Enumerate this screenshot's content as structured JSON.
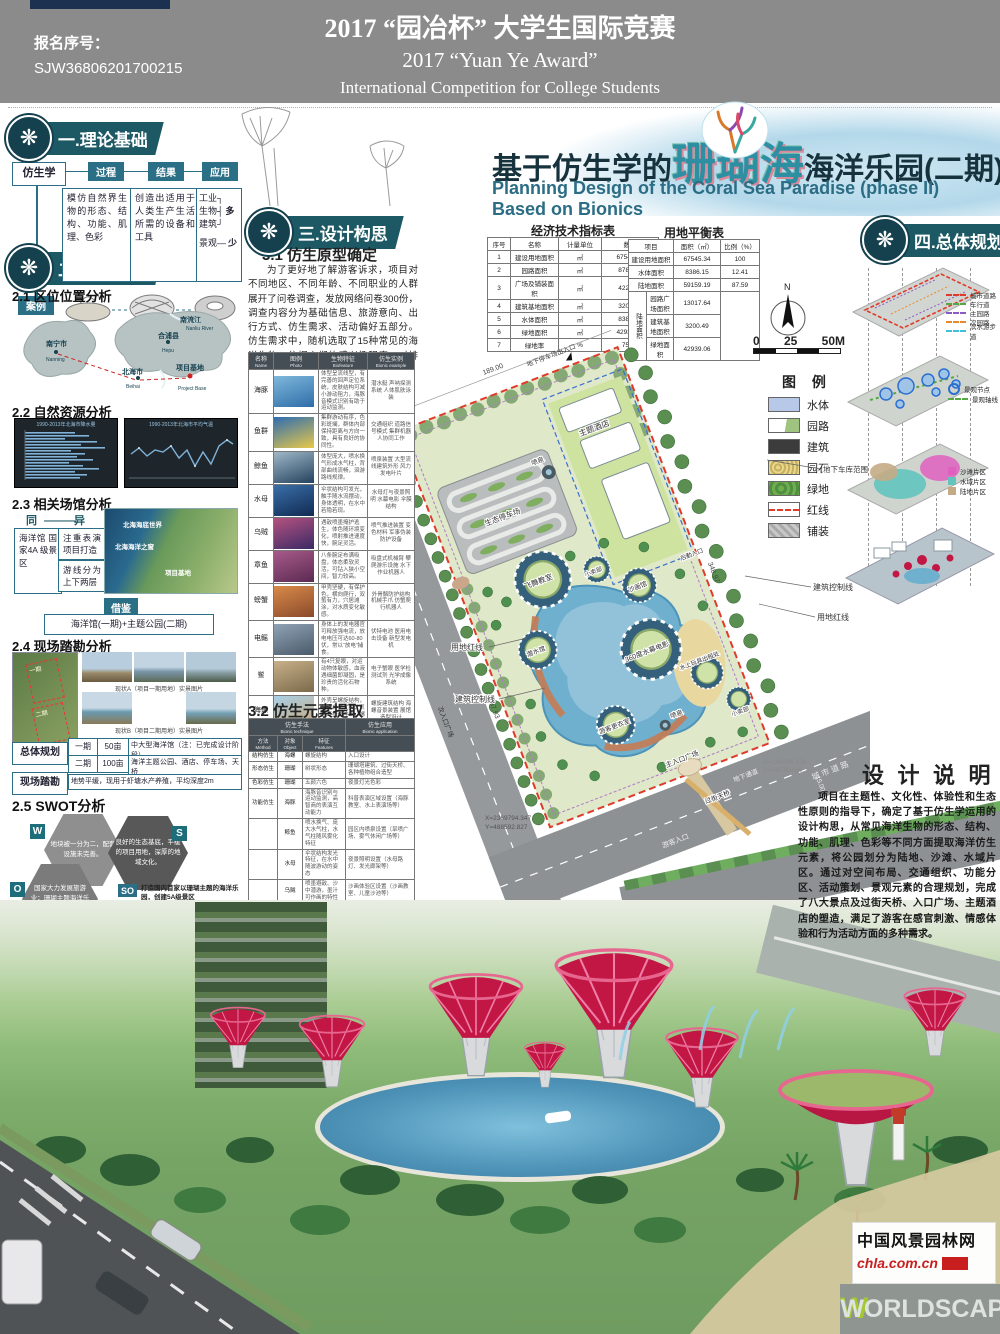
{
  "colors": {
    "accent_teal": "#1d5964",
    "diagram_teal": "#2a6f86",
    "red_line": "#e03a2a",
    "header_gray": "#8b8b8b",
    "table_header": "#454e55",
    "canopy_pink": "#c21744"
  },
  "header": {
    "entry_label": "报名序号：",
    "entry_no": "SJW36806201700215",
    "title_cn": "2017 “园冶杯” 大学生国际竞赛",
    "title_award": "2017 “Yuan Ye Award”",
    "title_en": "International Competition for College Students"
  },
  "title": {
    "cn_prefix": "基于仿生学的",
    "cn_highlight": "珊瑚海",
    "cn_suffix": "海洋乐园(二期)规划设计",
    "en": "Planning Design of the Coral Sea Paradise (phase II) Based on Bionics"
  },
  "badges": {
    "b1": "一.理论基础",
    "b2": "二.前期分析",
    "b3": "三.设计构思",
    "b4": "四.总体规划"
  },
  "theory": {
    "subject": "仿生学",
    "stage1": "过程",
    "stage2": "结果",
    "stage3": "应用",
    "box1": "模仿自然界生物的形态、结构、功能、肌理、色彩",
    "box2": "创造出适用于人类生产生活所需的设备和工具",
    "app1": "工业",
    "app2": "生物",
    "app3": "建筑",
    "app4": "景观",
    "more": "多",
    "less": "少",
    "case_label": "案例"
  },
  "loc": {
    "heading": "2.1 区位位置分析",
    "nanning": "南宁市",
    "nanning_en": "Nanning",
    "hepu": "合浦县",
    "hepu_en": "Hepu",
    "beihai": "北海市",
    "beihai_en": "Beihai",
    "base": "项目基地",
    "base_en": "Project Base",
    "river": "南流江",
    "river_en": "Nanliu River"
  },
  "nature": {
    "heading": "2.2 自然资源分析",
    "chart1_title": "1990-2013年北海市降水量",
    "chart2_title": "1990-2013年北海市平均气温"
  },
  "venues": {
    "heading": "2.3 相关场馆分析",
    "same": "同",
    "diff": "异",
    "box_same": "海洋馆 国家4A 级景区",
    "box_d1": "注重表演 项目打造",
    "box_d2": "游线分为 上下两层",
    "tag1": "北海海底世界",
    "tag2": "北海海洋之窗",
    "tag3": "项目基地",
    "ref_label": "借鉴",
    "ref_text": "海洋馆(一期)+主题公园(二期)"
  },
  "survey": {
    "heading": "2.4 现场踏勘分析",
    "tag1": "一期",
    "tag2": "二期",
    "cap1": "现状A（项目一期用地）实景图片",
    "cap2": "现状B（项目二期用地）实景图片",
    "flow_left1": "总体规划",
    "flow_left2": "现场踏勘",
    "p1": "一期",
    "a1": "50亩",
    "d1": "中大型海洋馆（注：已完成设计阶段）",
    "p2": "二期",
    "a2": "100亩",
    "d2": "海洋主题公园、酒店、停车场、天桥",
    "survey_text": "地势平缓，现用于虾塘水产养殖，平均深度2m"
  },
  "swot": {
    "heading": "2.5 SWOT分析",
    "w": "地块被一分为二，配套设施未完善。",
    "s": "良好的生态基底，平缓的项目用地，深厚的地域文化。",
    "o": "国家大力发展旅游业；珊瑚主题海洋乐园尚且未有先例",
    "t": "与同城优秀旅游景区存在竞争；海洋主题公园大同小异",
    "quads": [
      {
        "key": "SO",
        "text": "打造国内首家以珊瑚主题的海洋乐园，创建5A级景区"
      },
      {
        "key": "WO",
        "text": "建设园内过街天桥便于游客游玩，公园建设与配套设施完善相互促进"
      },
      {
        "key": "ST",
        "text": "采用仿生设计手法"
      },
      {
        "key": "WT",
        "text": "加强硬软件建设，确保游客良好体验"
      }
    ]
  },
  "concept": {
    "heading1": "3.1 仿生原型确定",
    "para": "为了更好地了解游客诉求，项目对不同地区、不同年龄、不同职业的人群展开了问卷调查，发放网络问卷300份，调查内容分为基础信息、旅游意向、出行方式、仿生需求、活动偏好五部分。仿生需求中，随机选取了15种常见的海洋生物，依据人们的感兴趣程度，对排名前十的生物进行相关研究。",
    "heading2": "3.2 仿生元素提取"
  },
  "species_table": {
    "h_name": "名称",
    "h_name_en": "Name",
    "h_photo": "图例",
    "h_photo_en": "Photo",
    "h_feat": "生物特征",
    "h_feat_en": "Biofeature",
    "h_ex": "仿生实例",
    "h_ex_en": "Bionic example",
    "rows": [
      {
        "name": "海豚",
        "photo": "linear-gradient(160deg,#7fb8dc,#2e6da8)",
        "feature": "体型呈流线型，有完善的回声定位系统，皮肤结构可减小游动阻力，海豚音模式识别有助于运动监测。",
        "example": "潜水艇 声呐探测系统 人体肌肤泳装"
      },
      {
        "name": "鱼群",
        "photo": "linear-gradient(160deg,#2e6db0,#e8c84a)",
        "feature": "集群游动有序，色彩斑斓，群体内部保持距离与方向一致，具有良好的协同性。",
        "example": "交通组织 道路信号模式 集群机器人协同工作"
      },
      {
        "name": "鲸鱼",
        "photo": "linear-gradient(160deg,#9fb8c8,#23425e)",
        "feature": "体型庞大，喷水换气形成水气柱，背部曲线流畅，洄游路线规律。",
        "example": "喷泉装置 大型流线建筑外形 风力发电叶片"
      },
      {
        "name": "水母",
        "photo": "linear-gradient(160deg,#3a6fa8,#102a52)",
        "feature": "伞状结构可发光，触手随水流摆动，身体透明，在水中若隐若现。",
        "example": "水母灯与夜景照明 水幕电影 伞膜结构"
      },
      {
        "name": "乌贼",
        "photo": "linear-gradient(160deg,#b5527f,#3a2a66)",
        "feature": "遇敌喷墨掩护逃生，体色随环境变化，喷射推进速度快，腕足灵活。",
        "example": "喷气推进装置 变色材料 军事伪装防护设备"
      },
      {
        "name": "章鱼",
        "photo": "linear-gradient(160deg,#a85a8a,#5a2a52)",
        "feature": "八条腕足布满吸盘，体态柔软灵活，可钻入狭小空间，智力较高。",
        "example": "吸盘式机械臂 攀爬游乐设施 水下作业机器人"
      },
      {
        "name": "螃蟹",
        "photo": "linear-gradient(160deg,#d88a4a,#8a4a2a)",
        "feature": "甲壳坚硬，有保护色，横向爬行，双螯有力，穴居滩涂，对水质变化敏感。",
        "example": "外骨骼防护结构 机械手爪 仿蟹爬行机器人"
      },
      {
        "name": "电鳐",
        "photo": "linear-gradient(160deg,#8fa3b5,#4a5a6a)",
        "feature": "身体上的发电器官可释放强电流，放电电压可达60-80伏，常以“放电”捕食。",
        "example": "伏特电池 医用电击设备 新型发电机"
      },
      {
        "name": "鲎",
        "photo": "linear-gradient(160deg,#c8b08a,#7a6a4a)",
        "feature": "有4只复眼，对运动物体敏感，血液遇细菌即凝固，是珍贵的活化石物种。",
        "example": "电子蟹眼 医学检测试剂 光学成像系统"
      },
      {
        "name": "海螺",
        "photo": "linear-gradient(160deg,#a8d0e8,#caa878)",
        "feature": "外壳呈螺旋结构，纹理自然优美，贝壳可抵御冲击，螺声如海。",
        "example": "螺旋建筑结构 海螺音景装置 展馆造型设计"
      }
    ]
  },
  "element_table": {
    "h_tech": "仿生手法",
    "h_tech_en": "Bionic technique",
    "h_app": "仿生应用",
    "h_app_en": "Bionic application",
    "h_method": "方法",
    "h_method_en": "Method",
    "h_obj": "对象",
    "h_obj_en": "Object",
    "h_feat": "特征",
    "h_feat_en": "Features",
    "rows": [
      {
        "method": "结构仿生",
        "object": "海螺",
        "feature": "螺旋结构",
        "app": "入口设计"
      },
      {
        "method": "形态仿生",
        "object": "珊瑚",
        "feature": "树状形态",
        "app": "珊瑚塔建筑、过街天桥、各种植物组合造型"
      },
      {
        "method": "色彩仿生",
        "object": "珊瑚",
        "feature": "五颜六色",
        "app": "夜景灯光色彩"
      },
      {
        "method": "功能仿生",
        "object": "海豚",
        "feature": "海豚音识别与运动监测，高智商的表演互动能力",
        "app": "科普表演区域设置（海豚教室、水上表演场等）"
      },
      {
        "method": "",
        "object": "鲸鱼",
        "feature": "喷水换气、庞大水气柱，水气柱随风雾化特征",
        "app": "园区内喷泉设置（旱喷广场、雾气休闲广场等）"
      },
      {
        "method": "",
        "object": "水母",
        "feature": "伞状结构发光特征，在水中随波游动的姿态",
        "app": "夜景照明设置（水母路灯、发光廊架等）"
      },
      {
        "method": "",
        "object": "乌贼",
        "feature": "喷墨避敌、沙中潜游，墨汁可作画的特性",
        "app": "沙画体验区设置（沙画教室、儿童沙池等）"
      },
      {
        "method": "",
        "object": "章鱼",
        "feature": "吸盘攀附、腕足缠绕的运动方式",
        "app": "儿童游乐设施设置（攀爬网、淘气堡等）"
      },
      {
        "method": "",
        "object": "螃蟹",
        "feature": "横向运动的独特方式与滩涂穴居习性",
        "app": "游乐设备设置（碰碰车、旋转椅等）"
      },
      {
        "method": "",
        "object": "电鳐",
        "feature": "放电发光特性与电流释放原理",
        "app": "水幕电影放映设置（360度水幕电影等）"
      },
      {
        "method": "",
        "object": "海螺",
        "feature": "海螺可听海的声学构造与贝壳纹理",
        "app": "互动体验装置设置（海螺音景、贝壳展示墙等）"
      },
      {
        "method": "环境仿生",
        "object": "人与海",
        "feature": "和谐共生",
        "app": "全园设计"
      }
    ]
  },
  "econ_table": {
    "title": "经济技术指标表",
    "h_no": "序号",
    "h_name": "名称",
    "h_unit": "计量单位",
    "h_qty": "数量",
    "rows": [
      {
        "no": "1",
        "name": "建设用地面积",
        "unit": "㎡",
        "qty": "67545.34"
      },
      {
        "no": "2",
        "name": "园路面积",
        "unit": "㎡",
        "qty": "8789.26"
      },
      {
        "no": "3",
        "name": "广场及铺装面积",
        "unit": "㎡",
        "qty": "4228.38"
      },
      {
        "no": "4",
        "name": "建筑基地面积",
        "unit": "㎡",
        "qty": "3200.49"
      },
      {
        "no": "5",
        "name": "水体面积",
        "unit": "㎡",
        "qty": "8386.15"
      },
      {
        "no": "6",
        "name": "绿地面积",
        "unit": "㎡",
        "qty": "42939.06"
      },
      {
        "no": "7",
        "name": "绿地率",
        "unit": "%",
        "qty": "75.99"
      }
    ]
  },
  "land_table": {
    "title": "用地平衡表",
    "h_item": "项目",
    "h_area": "面积（㎡）",
    "h_ratio": "比例（%）",
    "r1_name": "建设用地面积",
    "r1_area": "67545.34",
    "r1_ratio": "100",
    "r2_name": "水体面积",
    "r2_area": "8386.15",
    "r2_ratio": "12.41",
    "r3_name": "陆地面积",
    "r3_area": "59159.19",
    "r3_ratio": "87.59",
    "group_label": "陆地面积",
    "g1_name": "园路广场面积",
    "g1_area": "13017.64",
    "g2_name": "建筑基地面积",
    "g2_area": "3200.49",
    "g3_name": "绿地面积",
    "g3_area": "42939.06"
  },
  "plan": {
    "compass": "N",
    "scale0": "0",
    "scale25": "25",
    "scale50": "50M",
    "eco_parking": "生态停车场",
    "hotel": "主题酒店",
    "garage_zone": "地下车库范围",
    "garage_entry": "地下停车场出入口",
    "fountain": "喷泉",
    "classroom": "飞舞教室",
    "kiosk": "小卖部",
    "sand_hall": "沙画馆",
    "dive_hall": "潜水馆",
    "cinema": "360度水幕电影",
    "toy_rental": "水上玩具出租处",
    "changing": "游客更衣室",
    "main_plaza": "主入口广场",
    "sub_plaza": "次入口广场",
    "visitor_entry": "游客入口",
    "service_entry": "后勤入口",
    "underpass": "地下通道",
    "footbridge": "过街天桥",
    "red_line": "用地红线",
    "ctrl_line": "建筑控制线",
    "city_road": "城 市 道 路",
    "d1": "189.00",
    "d2": "30.00",
    "d3": "307.93",
    "d4": "348.97",
    "d5": "15.00",
    "x1": "X=2369794.347",
    "y1": "Y=488592.827",
    "x2": "X=2369794.079",
    "y2": "Y=488750.089"
  },
  "legend": {
    "title": "图 例",
    "i1": "水体",
    "i2": "园路",
    "i3": "建筑",
    "i4": "园石",
    "i5": "绿地",
    "i6": "红线",
    "i7": "铺装"
  },
  "master": {
    "road_legend": [
      {
        "label": "城市道路",
        "color": "#e03a2a"
      },
      {
        "label": "车行道",
        "color": "#55a845"
      },
      {
        "label": "主园路",
        "color": "#8a5bc4"
      },
      {
        "label": "次园路",
        "color": "#e88a2c"
      },
      {
        "label": "滨水游步道",
        "color": "#3ec0d8"
      }
    ],
    "node1": "景观节点",
    "node2": "景观轴线",
    "zone_legend": [
      {
        "label": "沙滩片区",
        "color": "#e060c0"
      },
      {
        "label": "水域片区",
        "color": "#62c4bc"
      },
      {
        "label": "陆地片区",
        "color": "#c4ab85"
      }
    ]
  },
  "design_note": {
    "title": "设 计 说 明",
    "para": "项目在主题性、文化性、体验性和生态性原则的指导下，确定了基于仿生学运用的设计构思，从常见海洋生物的形态、结构、功能、肌理、色彩等不同方面提取海洋仿生元素，将公园划分为陆地、沙滩、水域片区。通过对空间布局、交通组织、功能分区、活动策划、景观元素的合理规划，完成了八大景点及过街天桥、入口广场、主题酒店的塑造，满足了游客在感官刺激、情感体验和行为活动方面的多种需求。"
  },
  "watermark": {
    "site": "中国风景园林网",
    "url": "chla.com.cn",
    "brand": "WORLDSCAPE"
  }
}
